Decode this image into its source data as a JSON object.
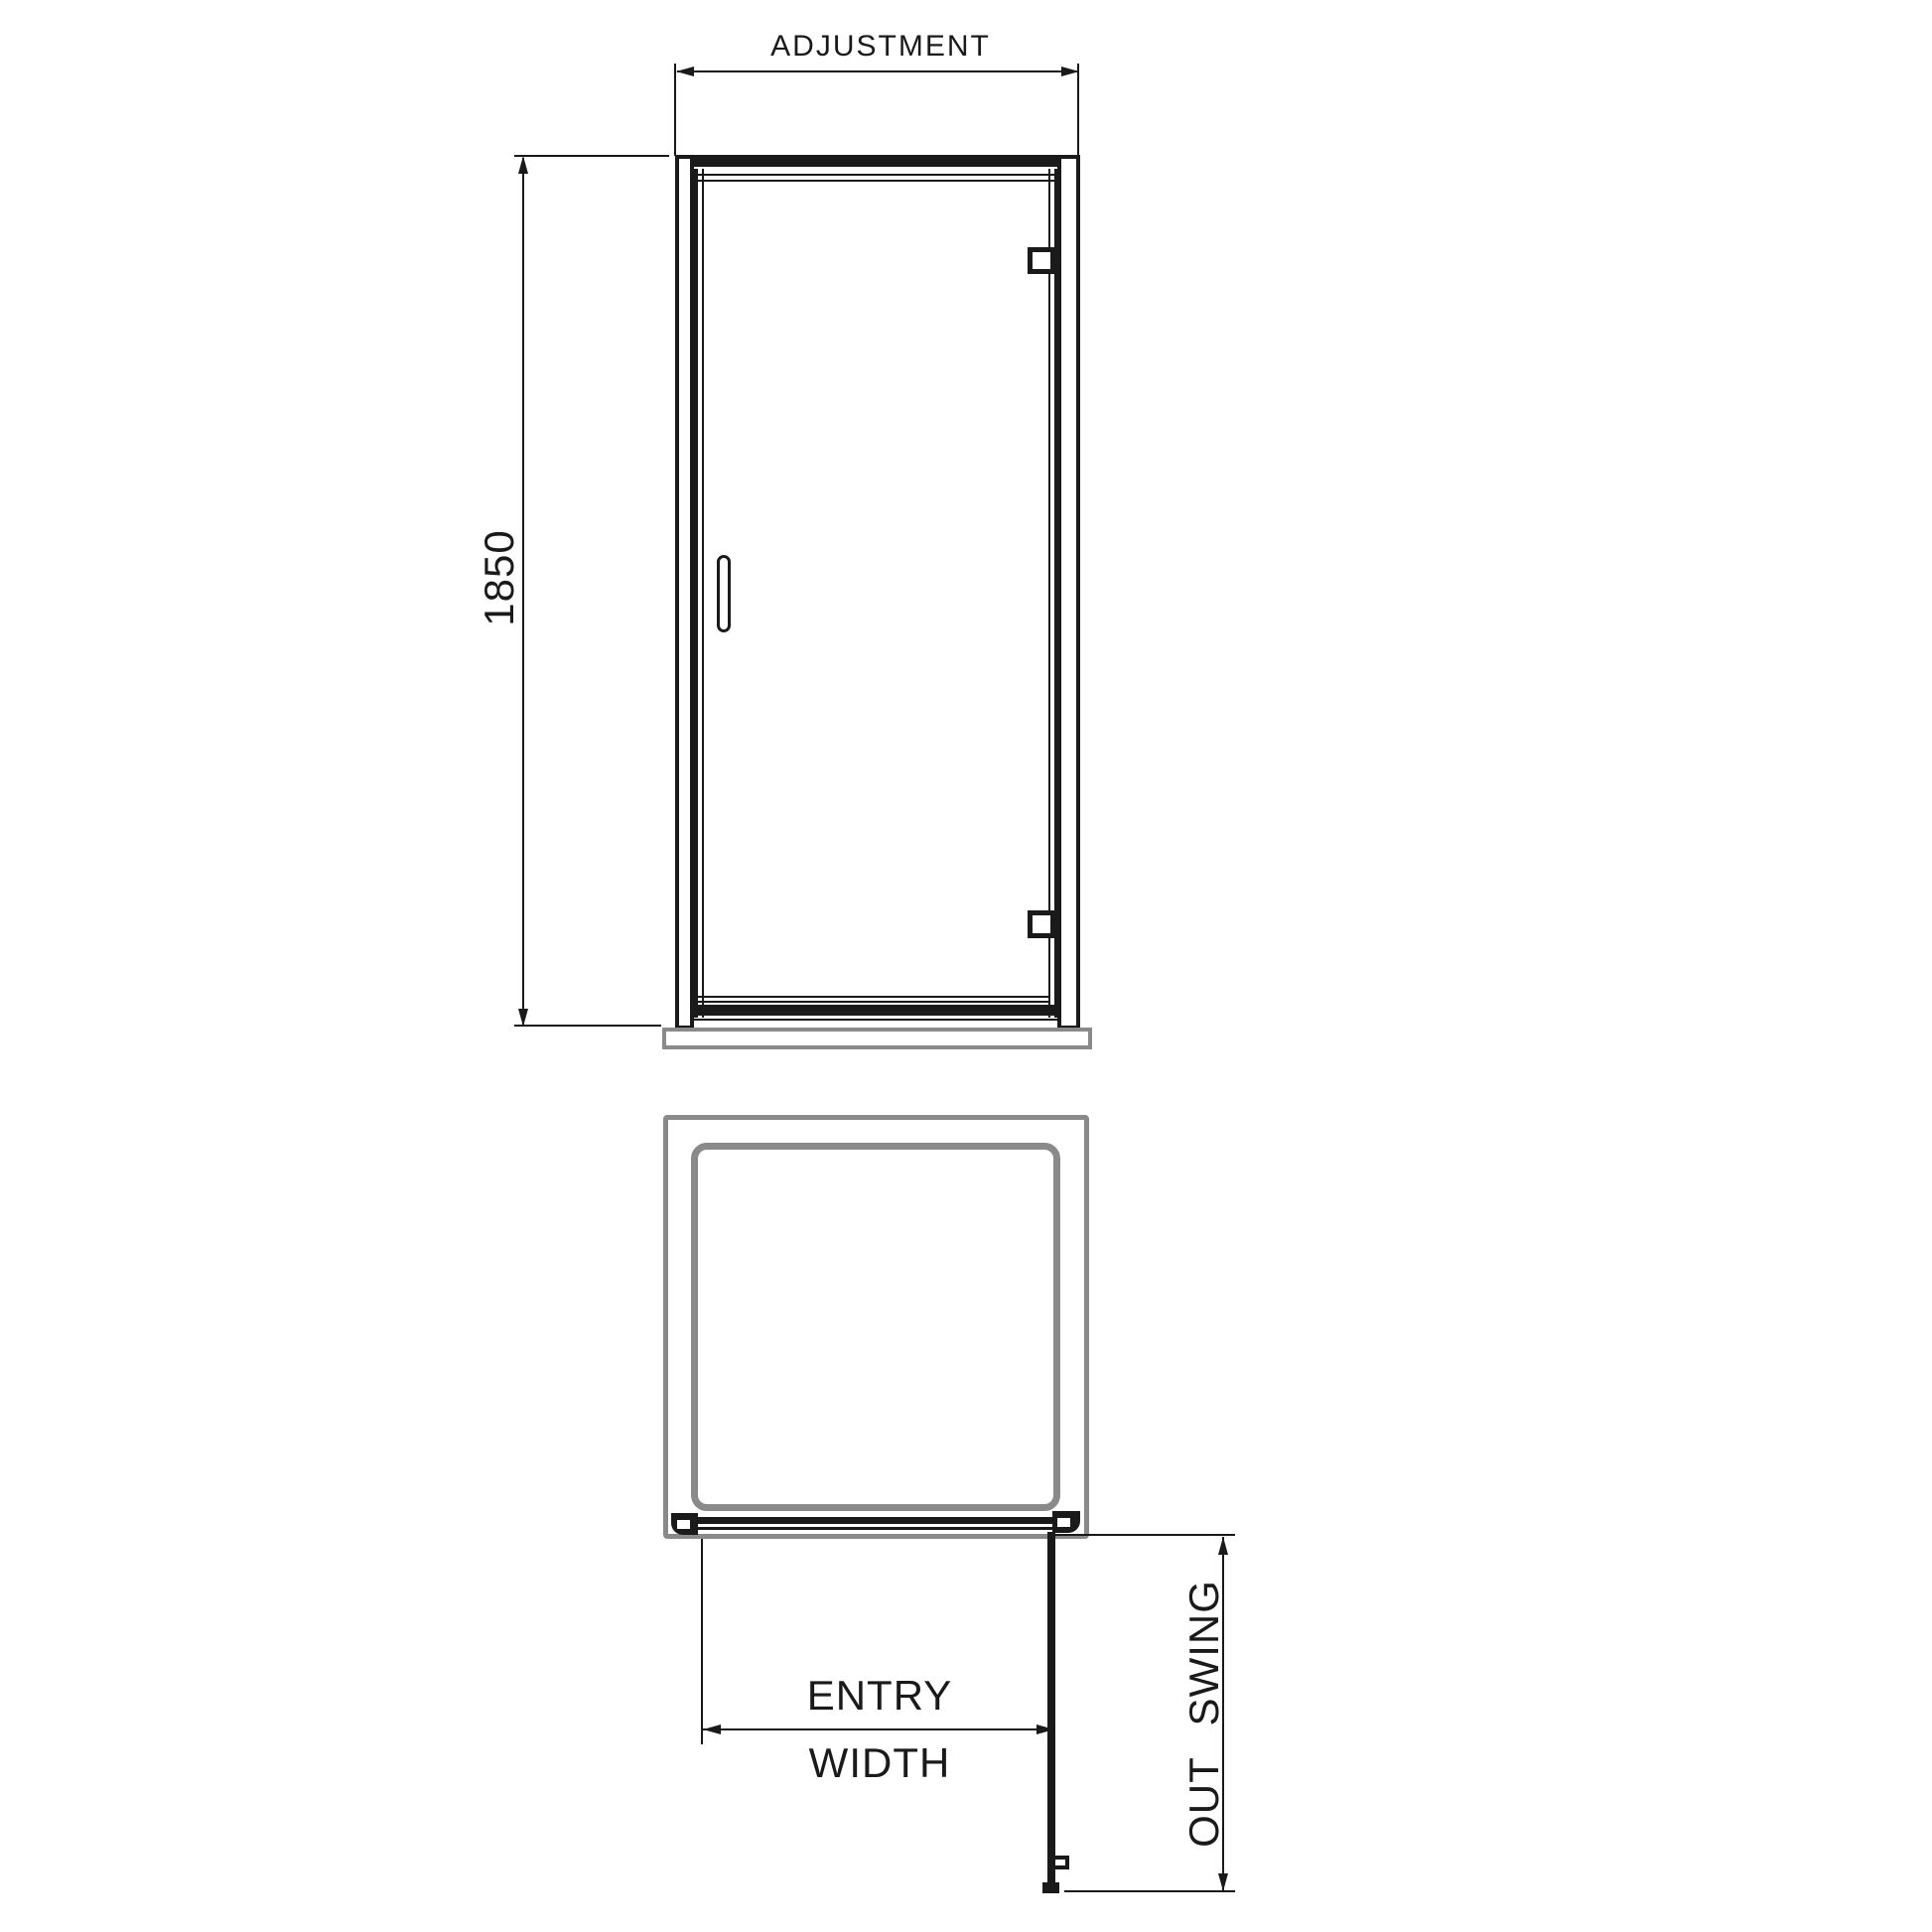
{
  "title": "Shower door dimension drawing",
  "colors": {
    "line": "#1a1a1a",
    "secondary": "#8a8a8a",
    "background": "#ffffff"
  },
  "elevation_view": {
    "dimensions": {
      "adjustment": {
        "label": "ADJUSTMENT",
        "orientation": "horizontal"
      },
      "height": {
        "label": "1850",
        "orientation": "vertical"
      }
    }
  },
  "plan_view": {
    "dimensions": {
      "entry_width": {
        "label_line1": "ENTRY",
        "label_line2": "WIDTH",
        "orientation": "horizontal"
      },
      "out_swing": {
        "label": "OUT SWING",
        "orientation": "vertical"
      }
    }
  }
}
